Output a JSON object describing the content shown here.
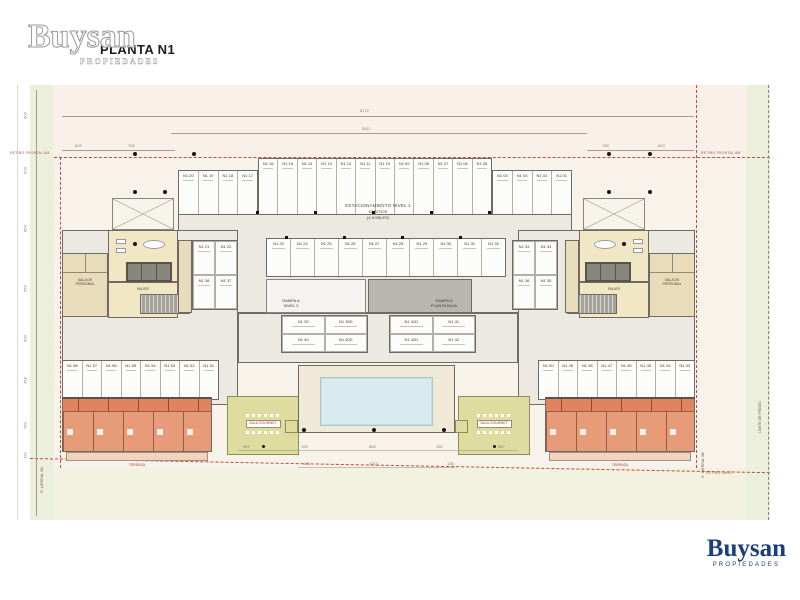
{
  "header": {
    "plan_title": "PLANTA N1",
    "watermark": {
      "brand": "Buysan",
      "sub": "PROPIEDADES"
    }
  },
  "footer": {
    "brand": "Buysan",
    "sub": "PROPIEDADES",
    "color": "#1c3e7d"
  },
  "plan": {
    "central_label": {
      "line1": "ESTACIONAMIENTO NIVEL 1",
      "line2": "62 SITIOS",
      "line3": "(4 DOBLES)"
    },
    "ramp_left": "RAMPA A\nNIVEL 2",
    "ramp_right": "RAMPA A\nPLANTA BAJA",
    "rooms": {
      "lobby_left": "LOBBY",
      "lobby_right": "LOBBY",
      "palier_left": "PALIER",
      "palier_right": "PALIER",
      "staff_left": "SALA DE\nPERSONAL",
      "staff_right": "SALA DE\nPERSONAL",
      "gourmet_left": "SALA GOURMET",
      "gourmet_right": "SALA GOURMET",
      "terrace_left": "TERRAZA",
      "terrace_right": "TERRAZA"
    },
    "stalls": {
      "top_left_sec": [
        "N1 20",
        "N1 19",
        "N1 18",
        "N1 17"
      ],
      "top_center_sec": [
        "N1 16",
        "N1 15",
        "N1 14",
        "N1 13",
        "N1 12",
        "N1 11",
        "N1 10",
        "N1 09",
        "N1 08",
        "N1 07",
        "N1 06",
        "N1 05"
      ],
      "top_right_sec": [
        "N1 04",
        "N1 03",
        "N1 02",
        "N1 01"
      ],
      "mid_row": [
        "N1 23",
        "N1 24",
        "N1 25",
        "N1 26",
        "N1 27",
        "N1 28",
        "N1 29",
        "N1 30",
        "N1 31",
        "N1 32"
      ],
      "left_pairs": [
        "N1 21",
        "N1 22",
        "N1 38",
        "N1 37"
      ],
      "right_pairs": [
        "N1 33",
        "N1 34",
        "N1 36",
        "N1 35"
      ],
      "doubles_left": [
        "N1 39",
        "N1 39D",
        "N1 40",
        "N1 40D"
      ],
      "doubles_right": [
        "N1 41D",
        "N1 41",
        "N1 42D",
        "N1 42"
      ],
      "bottom_left": [
        "N1 58",
        "N1 57",
        "N1 56",
        "N1 55",
        "N1 54",
        "N1 53",
        "N1 52",
        "N1 51"
      ],
      "bottom_right": [
        "N1 50",
        "N1 49",
        "N1 48",
        "N1 47",
        "N1 46",
        "N1 45",
        "N1 44",
        "N1 43"
      ]
    },
    "dimensions": {
      "top_total": "8172",
      "top_inner": "5511",
      "top_left_a": "603",
      "top_left_b": "798",
      "top_right_a": "798",
      "top_right_b": "603",
      "left_chain": [
        "800",
        "629",
        "854",
        "650",
        "600",
        "458",
        "783",
        "192"
      ],
      "bottom_row1": [
        "987",
        "192",
        "665",
        "190",
        "987"
      ],
      "bottom_row2": [
        "136",
        "1013",
        "136"
      ]
    },
    "site_labels": {
      "retiro_frontal_left": "RETIRO FRONTAL 8M",
      "retiro_frontal_right": "RETIRO FRONTAL 8M",
      "lateral_left": "R. LATERAL 3M",
      "lateral_right": "R. LATERAL 3M",
      "retiro_bottom": "RETIRO LAGO",
      "limite": "LIMITE DE PREDIO"
    }
  }
}
